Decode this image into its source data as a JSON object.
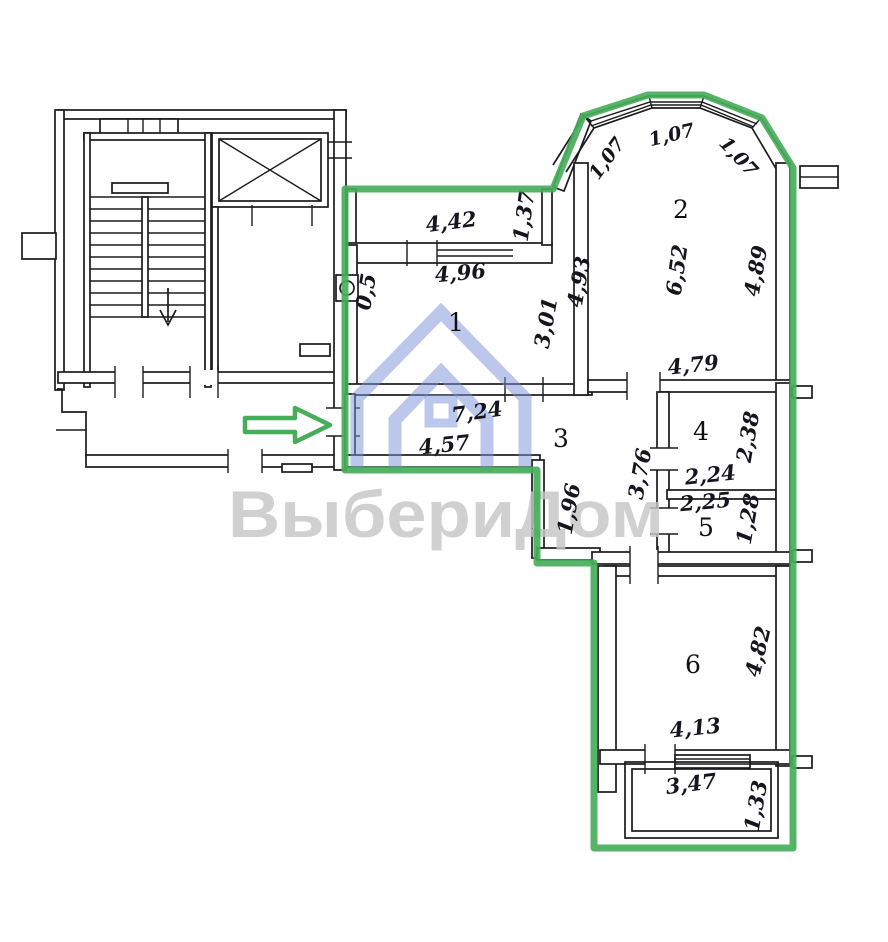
{
  "watermark": {
    "text": "ВыбериДом"
  },
  "colors": {
    "highlight_green": "#46ae5a",
    "logo_blue": "#7a90da",
    "watermark_gray": "#c6c6c6",
    "wall_ink": "#1b1b1b"
  },
  "plan": {
    "bay": {
      "seg_left": "1,07",
      "seg_top": "1,07",
      "seg_right": "1,07"
    },
    "loggia_top": {
      "width": "4,42",
      "depth": "1,37"
    },
    "room1": {
      "number": "1",
      "width": "4,96",
      "height": "3,01",
      "niche": "0,5"
    },
    "room2": {
      "number": "2",
      "height": "6,52",
      "right": "4,89",
      "left": "4,93",
      "bottom": "4,79"
    },
    "room3": {
      "number": "3",
      "top_width": "7,24",
      "width": "4,57",
      "inner_height": "1,96",
      "right_height": "3,76"
    },
    "room4": {
      "number": "4",
      "height": "2,38",
      "width": "2,24"
    },
    "room5": {
      "number": "5",
      "width": "2,25",
      "height": "1,28"
    },
    "room6": {
      "number": "6",
      "height": "4,82",
      "width": "4,13"
    },
    "balcony_bottom": {
      "width": "3,47",
      "depth": "1,33"
    }
  }
}
